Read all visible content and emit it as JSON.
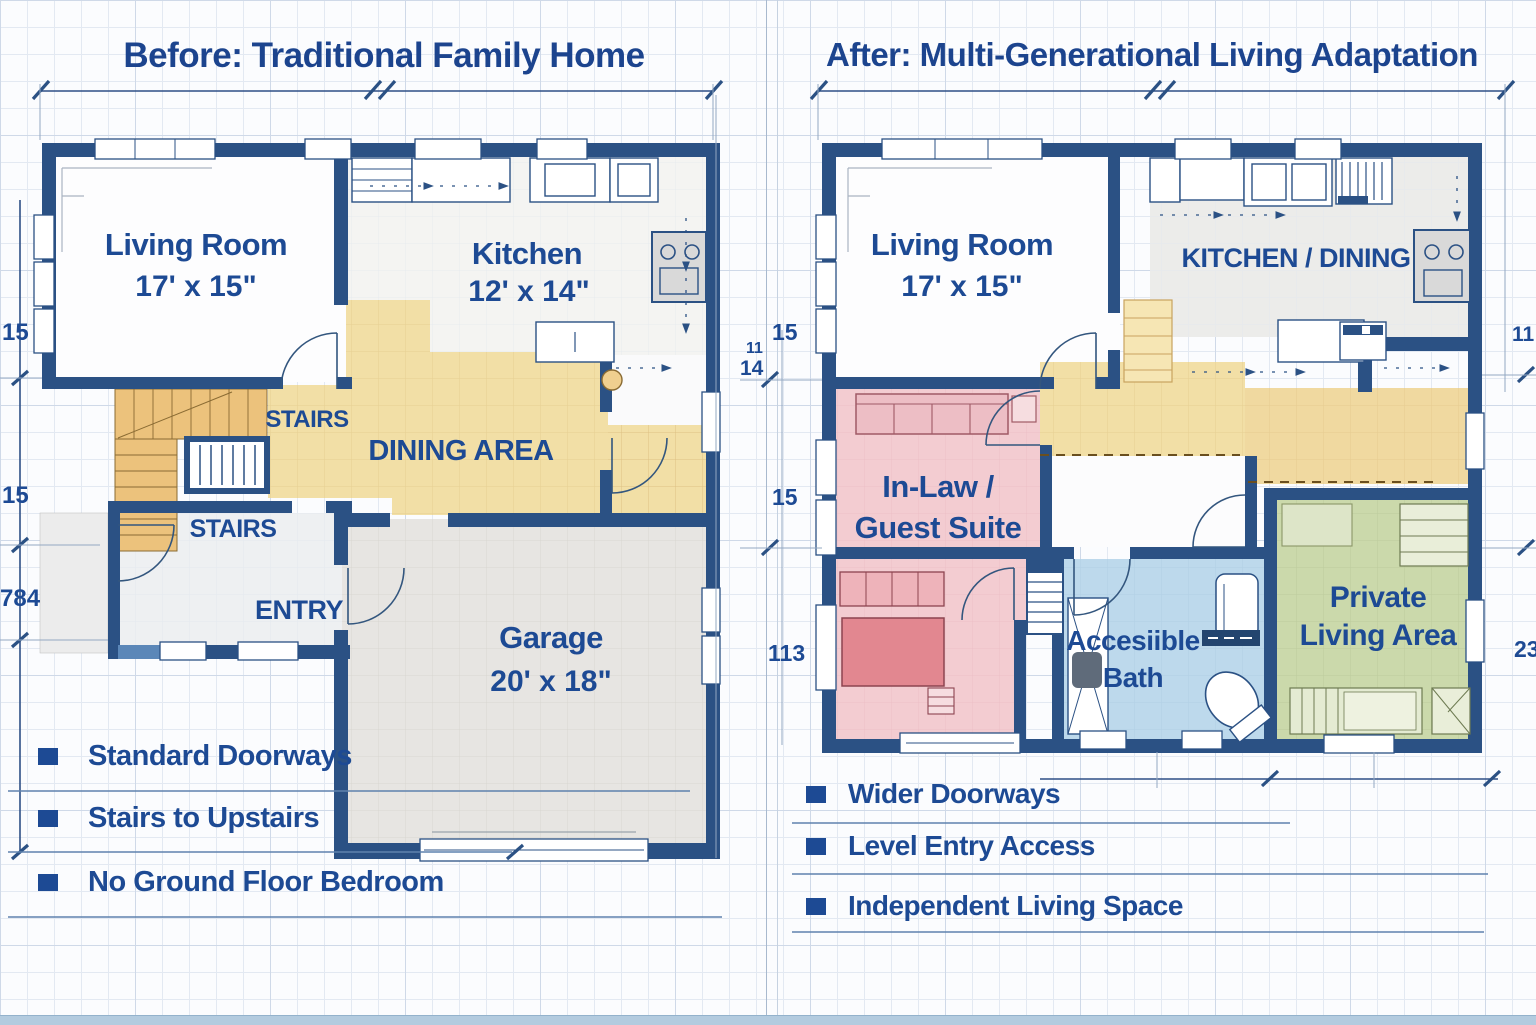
{
  "colors": {
    "wall_navy": "#2b5184",
    "label_blue": "#1d4a94",
    "title_blue": "#1c448e",
    "dining_tan": "#f2dfa6",
    "stairs_orange": "#ecc27c",
    "suite_pink": "#f3ccd1",
    "bed_pink": "#e28790",
    "bath_blue": "#bdd9ec",
    "private_green": "#cbd9ab",
    "garage_gray": "#e7e5e2",
    "kitchen_gray": "#ececea",
    "paper": "#fbfcfe",
    "bottom_strip": "#b3cbdf"
  },
  "left": {
    "title": "Before: Traditional Family Home",
    "rooms": {
      "living": {
        "name": "Living Room",
        "size": "17' x 15\""
      },
      "kitchen": {
        "name": "Kitchen",
        "size": "12' x 14\""
      },
      "stairs_upper": "STAIRS",
      "dining": "DINING AREA",
      "stairs_lower": "STAIRS",
      "entry": "ENTRY",
      "garage": {
        "name": "Garage",
        "size": "20' x 18\""
      }
    },
    "dims": {
      "left_top": "15",
      "left_mid": "15",
      "left_bottom": "784"
    },
    "bullets": [
      "Standard Doorways",
      "Stairs to Upstairs",
      "No Ground Floor Bedroom"
    ]
  },
  "right": {
    "title": "After: Multi-Generational Living Adaptation",
    "rooms": {
      "living": {
        "name": "Living Room",
        "size": "17' x 15\""
      },
      "kitchen": "KITCHEN / DINING",
      "inlaw": {
        "line1": "In-Law /",
        "line2": "Guest Suite"
      },
      "bath": {
        "line1": "Accesiible",
        "line2": "Bath"
      },
      "private": {
        "line1": "Private",
        "line2": "Living Area"
      }
    },
    "dims": {
      "left_top": "15",
      "left_small": "11",
      "left_mid2": "14",
      "left_mid": "15",
      "left_bottom": "113",
      "right_top": "11",
      "right_bottom": "23"
    },
    "bullets": [
      "Wider Doorways",
      "Level Entry Access",
      "Independent Living Space"
    ]
  }
}
